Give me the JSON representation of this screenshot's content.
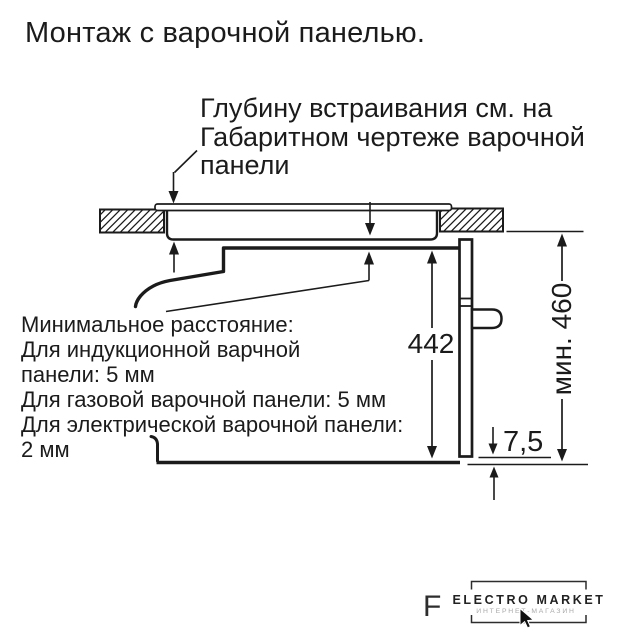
{
  "title": "Монтаж с варочной панелью.",
  "notes": {
    "embed_depth": [
      "Глубину встраивания см. на",
      "Габаритном чертеже варочной",
      "панели"
    ],
    "min_distance": [
      "Минимальное расстояние:",
      "Для индукционной варчной",
      "панели: 5 мм",
      "Для газовой варочной панели: 5 мм",
      "Для электрической варочной панели:",
      "2 мм"
    ]
  },
  "dimensions": {
    "oven_height_mm": "442",
    "niche_min_height": "мин. 460",
    "door_bottom_gap_mm": "7,5"
  },
  "watermark": {
    "prefix_letter": "F",
    "brand": "ELECTRO MARKET",
    "tagline": "ИНТЕРНЕТ-МАГАЗИН"
  },
  "colors": {
    "ink": "#1b1b1b",
    "background": "#ffffff"
  }
}
